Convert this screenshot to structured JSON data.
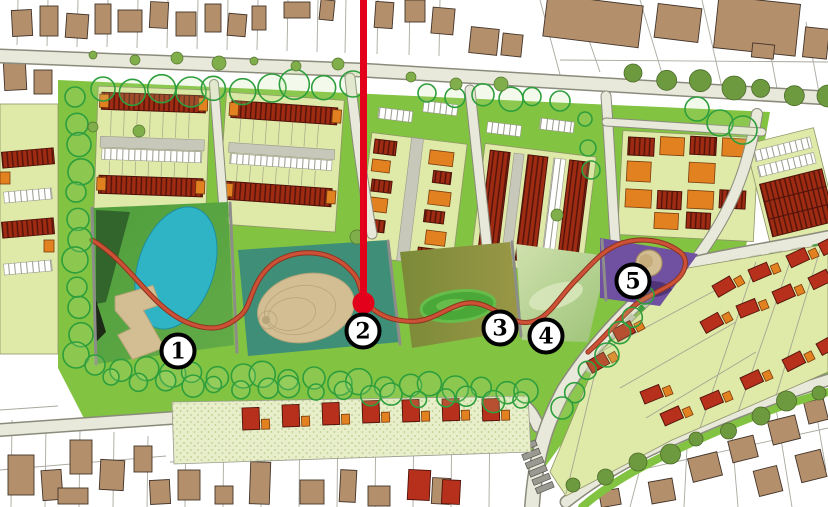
{
  "figure": {
    "kind": "urban-masterplan-map",
    "width": 828,
    "height": 507,
    "visible_text": [
      "1",
      "2",
      "3",
      "4",
      "5"
    ]
  },
  "markers": [
    {
      "label": "1",
      "x": 178,
      "y": 351
    },
    {
      "label": "2",
      "x": 363,
      "y": 331
    },
    {
      "label": "3",
      "x": 500,
      "y": 328
    },
    {
      "label": "4",
      "x": 546,
      "y": 336
    },
    {
      "label": "5",
      "x": 633,
      "y": 281
    }
  ],
  "pointer_line": {
    "x": 363.5,
    "y_start": 0,
    "y_end": 295,
    "dot_cx": 363.5,
    "dot_cy": 303,
    "dot_r": 11
  },
  "palette": {
    "accent_red": "#e3001b",
    "path_red": "#cc5136",
    "grass_green": "#82c341",
    "lime_plot": "#dfe9a8",
    "park1_green": "#55a23f",
    "park2_teal": "#3f8f78",
    "park3_olive": "#8e913f",
    "park4_sage": "#c2d9a0",
    "park5_purple": "#7050a0",
    "pond_blue": "#2fb4c6",
    "sand_tan": "#d3be93",
    "building_tan": "#b48f6b",
    "terrace_dark_red": "#9e2b12",
    "house_red": "#b6301c",
    "house_orange": "#e2811f",
    "road_fill": "#e9e9db",
    "tree_outline_green": "#2e9e3c",
    "tree_fill_olive": "#6e9a3f"
  }
}
